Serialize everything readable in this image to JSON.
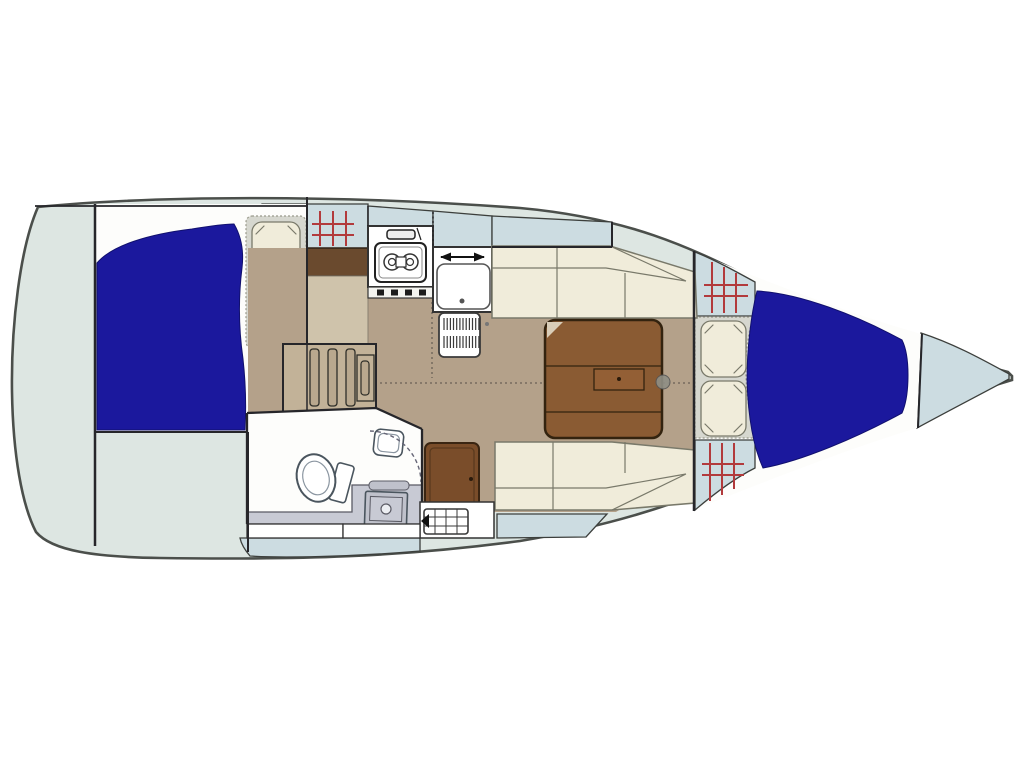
{
  "diagram": {
    "kind": "sailboat-interior-floor-plan",
    "view": "top-down",
    "bow_direction": "right"
  },
  "palette": {
    "page_bg": "#ffffff",
    "hull_fill": "#dde6e2",
    "hull_stroke": "#4b4f4b",
    "deck_band": "#ccdce1",
    "band_edge": "#3c3f3c",
    "wall_dark": "#26262a",
    "cabin_white": "#fdfdfb",
    "berth_navy": "#1b189d",
    "navy_edge": "#11106e",
    "pad_gray": "#d6d7cf",
    "pad_edge": "#9a9a8c",
    "cushion_cream": "#f0ecda",
    "cushion_edge": "#79796a",
    "floor_tan": "#b4a18a",
    "seam": "#6a6156",
    "table_brown": "#8a5b33",
    "table_edge": "#33230f",
    "table_fold": "#d9cdb8",
    "drawer_brown": "#935f35",
    "door_brown": "#7a4d2a",
    "door_edge": "#3a2512",
    "galley_bar": "#6a4a2e",
    "galley_step": "#cfc3ab",
    "wood_tan": "#b0987a",
    "slat_tan": "#b9a88e",
    "steps_bg": "#c2b298",
    "fixture_white": "#ffffff",
    "fixture_edge": "#333333",
    "head_fixture_edge": "#4a555e",
    "head_fixture_inner": "#8a95a0",
    "counter_gray": "#c8cad4",
    "counter_dark": "#bfc1cb",
    "counter_edge": "#5a5a64",
    "hatch_red": "#b23a3c",
    "metal_gray": "#8f8f85",
    "knob_dark": "#1c1c1c",
    "arrow_black": "#111111",
    "grate_line": "#3a3a3a",
    "dot_gray": "#777777"
  },
  "features": [
    "hull",
    "side-deck-windows",
    "anchor-locker",
    "aft-cabin-double-berth",
    "aft-cabin-pillows",
    "companionway-steps",
    "galley-stove",
    "galley-sink",
    "galley-fridge-vent",
    "salon-port-settee",
    "salon-starboard-settee",
    "salon-table",
    "head-toilet",
    "head-sink",
    "head-shower",
    "head-door",
    "v-berth",
    "v-berth-pillows",
    "deck-hatches"
  ]
}
